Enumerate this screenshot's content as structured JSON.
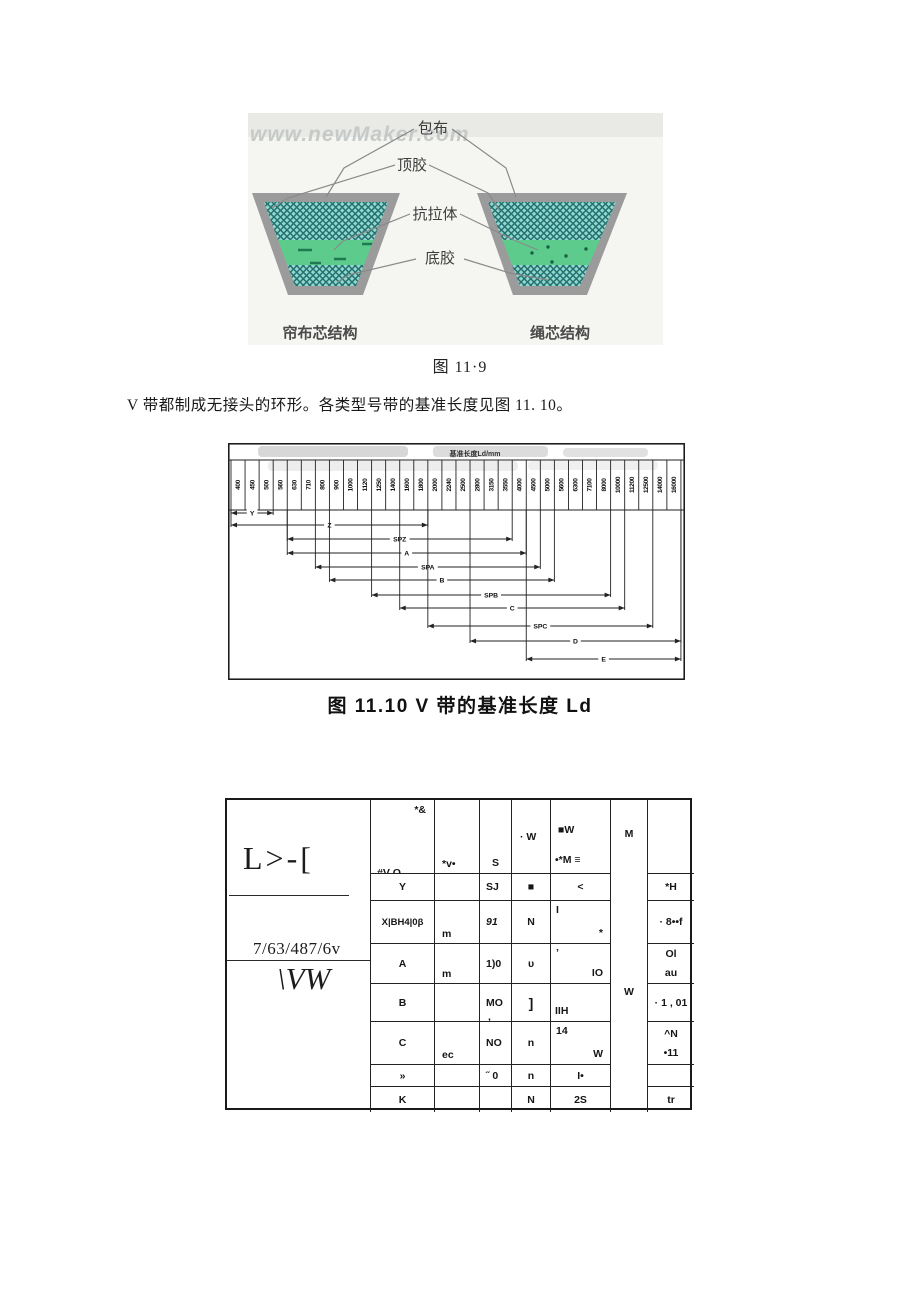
{
  "figure_belt": {
    "watermark": "www.newMaker.com",
    "callouts": [
      "包布",
      "顶胶",
      "抗拉体",
      "底胶"
    ],
    "left_structure": "帘布芯结构",
    "right_structure": "绳芯结构",
    "caption": "图 11·9",
    "colors": {
      "border_gray": "#9b9b9b",
      "hatch_teal": "#92d8d0",
      "hatch_line": "#23706e",
      "band_green": "#5dcb8b"
    }
  },
  "paragraph": "V 带都制成无接头的环形。各类型号带的基准长度见图 11. 10。",
  "chart_data": {
    "type": "bar",
    "subtype": "horizontal-range",
    "title": "基准长度Ld/mm",
    "caption": "图 11.10 V 带的基准长度 Ld",
    "categories": [
      400,
      450,
      500,
      560,
      630,
      710,
      800,
      900,
      1000,
      1120,
      1250,
      1400,
      1600,
      1800,
      2000,
      2240,
      2500,
      2800,
      3150,
      3550,
      4000,
      4500,
      5000,
      5600,
      6300,
      7100,
      8000,
      10000,
      11200,
      12500,
      14000,
      16000
    ],
    "series": [
      {
        "name": "Y",
        "from": 400,
        "to": 500
      },
      {
        "name": "Z",
        "from": 400,
        "to": 1800
      },
      {
        "name": "SPZ",
        "from": 630,
        "to": 3550
      },
      {
        "name": "A",
        "from": 630,
        "to": 4000
      },
      {
        "name": "SPA",
        "from": 800,
        "to": 4500
      },
      {
        "name": "B",
        "from": 900,
        "to": 5000
      },
      {
        "name": "SPB",
        "from": 1250,
        "to": 8000
      },
      {
        "name": "C",
        "from": 1600,
        "to": 10000
      },
      {
        "name": "SPC",
        "from": 2000,
        "to": 12500
      },
      {
        "name": "D",
        "from": 2800,
        "to": 16000
      },
      {
        "name": "E",
        "from": 4500,
        "to": 16000
      }
    ],
    "xlabel": "",
    "ylabel": "",
    "legend": "none",
    "grid": "columns"
  },
  "table": {
    "left_panel": {
      "text1": "L>-[",
      "text2": "7/63/487/6v",
      "text3": "\\VW"
    },
    "header": {
      "c1_top": "*&",
      "c1_bottom": "#V O",
      "c2": "*v•",
      "c3": "S",
      "c4": "· W",
      "c5_top": "■W",
      "c5_bottom": "•*M ≡",
      "c6": "M",
      "c7": ""
    },
    "merged_cell_body": "W",
    "rows": [
      {
        "c1": "Y",
        "c2": "",
        "c3": "SJ",
        "c3b": "",
        "c3_italic": false,
        "c4": "■",
        "c5": {
          "c": "<"
        },
        "c7": [
          "*H"
        ]
      },
      {
        "c1": "X|BH4|0β",
        "c2": "m",
        "c3": "91",
        "c3b": "",
        "c3_italic": true,
        "c4": "N",
        "c5": {
          "tl": "I",
          "br": "*"
        },
        "c7": [
          "· 8••f"
        ]
      },
      {
        "c1": "A",
        "c2": "m",
        "c3": "1)0",
        "c3b": "",
        "c3_italic": false,
        "c4": "υ",
        "c5": {
          "tl": "’",
          "br": "IO"
        },
        "c7": [
          "Ol",
          "au"
        ]
      },
      {
        "c1": "B",
        "c2": "",
        "c3": "MO",
        "c3b": ",",
        "c3_italic": false,
        "c4": "]",
        "c5": {
          "bl": "IIH"
        },
        "c7": [
          "· 1 , 01"
        ]
      },
      {
        "c1": "C",
        "c2": "ec",
        "c3": "NO",
        "c3b": "",
        "c3_italic": false,
        "c4": "n",
        "c5": {
          "tl": "14",
          "br": "W"
        },
        "c7": [
          "^N",
          "•11"
        ]
      },
      {
        "c1": "»",
        "c2": "",
        "c3": "˝ 0",
        "c3b": "",
        "c3_italic": false,
        "c4": "n",
        "c5": {
          "c": "I•"
        },
        "c7": []
      },
      {
        "c1": "K",
        "c2": "",
        "c3": "",
        "c3b": "",
        "c3_italic": false,
        "c4": "N",
        "c5": {
          "c": "2S"
        },
        "c7": [
          "tr"
        ]
      }
    ]
  }
}
